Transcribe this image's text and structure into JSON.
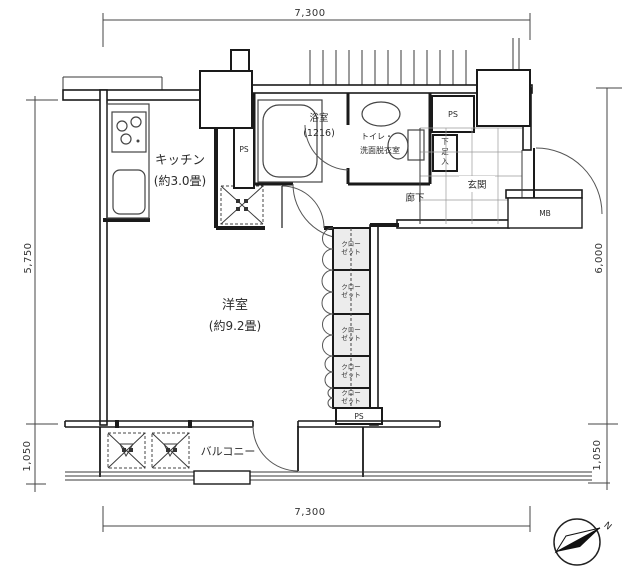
{
  "dimensions": {
    "top": "7,300",
    "bottom": "7,300",
    "left_main": "5,750",
    "left_sub": "1,050",
    "right_main": "6,000",
    "right_sub": "1,050"
  },
  "rooms": {
    "kitchen": {
      "name": "キッチン",
      "size": "(約3.0畳)"
    },
    "bathroom": {
      "name": "浴室",
      "size": "(1216)"
    },
    "washroom": {
      "line1": "トイレ・",
      "line2": "洗面脱衣室"
    },
    "entrance": {
      "name": "玄関"
    },
    "hallway": {
      "name": "廊下"
    },
    "main_room": {
      "name": "洋室",
      "size": "(約9.2畳)"
    },
    "balcony": {
      "name": "バルコニー"
    }
  },
  "fixtures": {
    "ps": "PS",
    "meter_box": "MB",
    "shoe_chars": [
      "下",
      "足",
      "入"
    ],
    "closet": {
      "line1": "クロー",
      "line2": "ゼット"
    }
  },
  "compass": {
    "north": "N"
  },
  "colors": {
    "wall": "#1a1a1a",
    "closet_fill": "#ececec",
    "background": "#ffffff"
  }
}
